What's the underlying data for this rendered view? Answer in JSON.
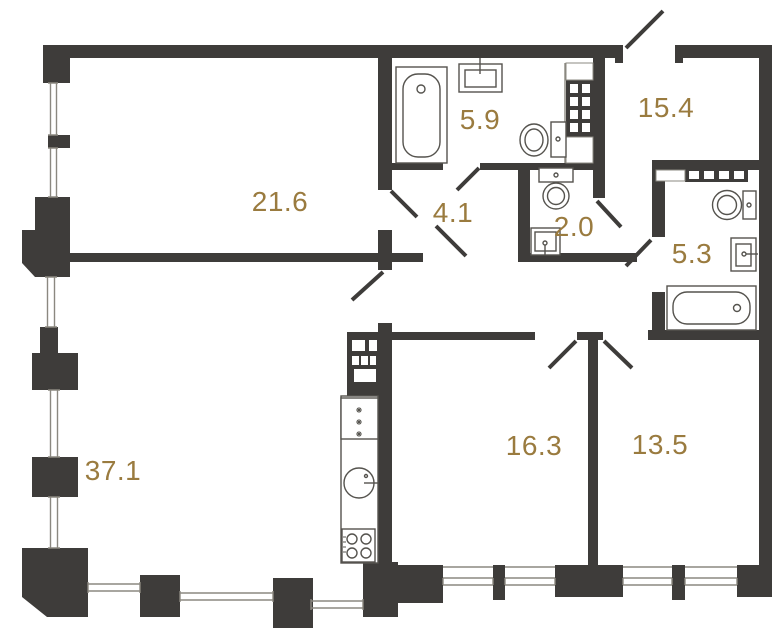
{
  "plan": {
    "type": "apartment-floor-plan",
    "colors": {
      "wall": "#3E3C3A",
      "label": "#9A7B3F",
      "fixture": "#55534E",
      "thin_line": "#8B8880",
      "background": "#FFFFFF"
    },
    "rooms": [
      {
        "name": "living-room",
        "area": "21.6"
      },
      {
        "name": "bathroom",
        "area": "5.9"
      },
      {
        "name": "entrance-hall",
        "area": "15.4"
      },
      {
        "name": "hallway",
        "area": "4.1"
      },
      {
        "name": "wc",
        "area": "2.0"
      },
      {
        "name": "bathroom-2",
        "area": "5.3"
      },
      {
        "name": "kitchen-living-room",
        "area": "37.1"
      },
      {
        "name": "bedroom",
        "area": "16.3"
      },
      {
        "name": "bedroom-2",
        "area": "13.5"
      }
    ],
    "fixtures": [
      "bathtub",
      "sink",
      "toilet",
      "ventilation-shaft",
      "refrigerator",
      "kitchen-sink",
      "stove",
      "door-swing",
      "window"
    ]
  }
}
